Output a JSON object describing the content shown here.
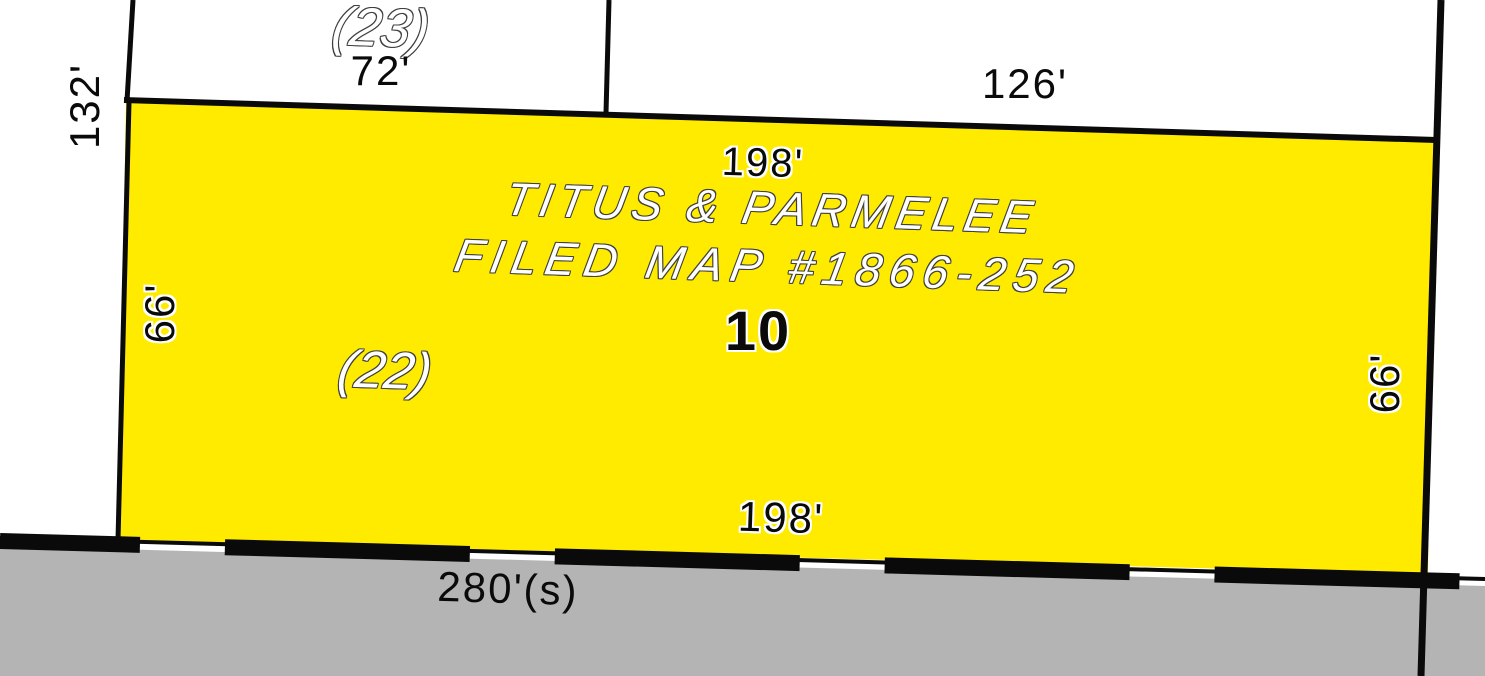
{
  "map": {
    "parcel": {
      "number": "10",
      "subdivision_line1": "TITUS & PARMELEE",
      "subdivision_line2": "FILED MAP #1866-252",
      "dim_top": "198'",
      "dim_bottom": "198'",
      "dim_left": "66'",
      "dim_right": "66'"
    },
    "adjacent": {
      "parcel_23_label": "(23)",
      "parcel_23_dim": "72'",
      "parcel_22_label": "(22)",
      "dim_left_outer": "132'",
      "dim_top_right": "126'"
    },
    "road": {
      "frontage_dim": "280'(s)"
    },
    "colors": {
      "parcel_fill": "#FFEB00",
      "road_fill": "#B4B4B4",
      "line": "#0A0A0A"
    }
  }
}
